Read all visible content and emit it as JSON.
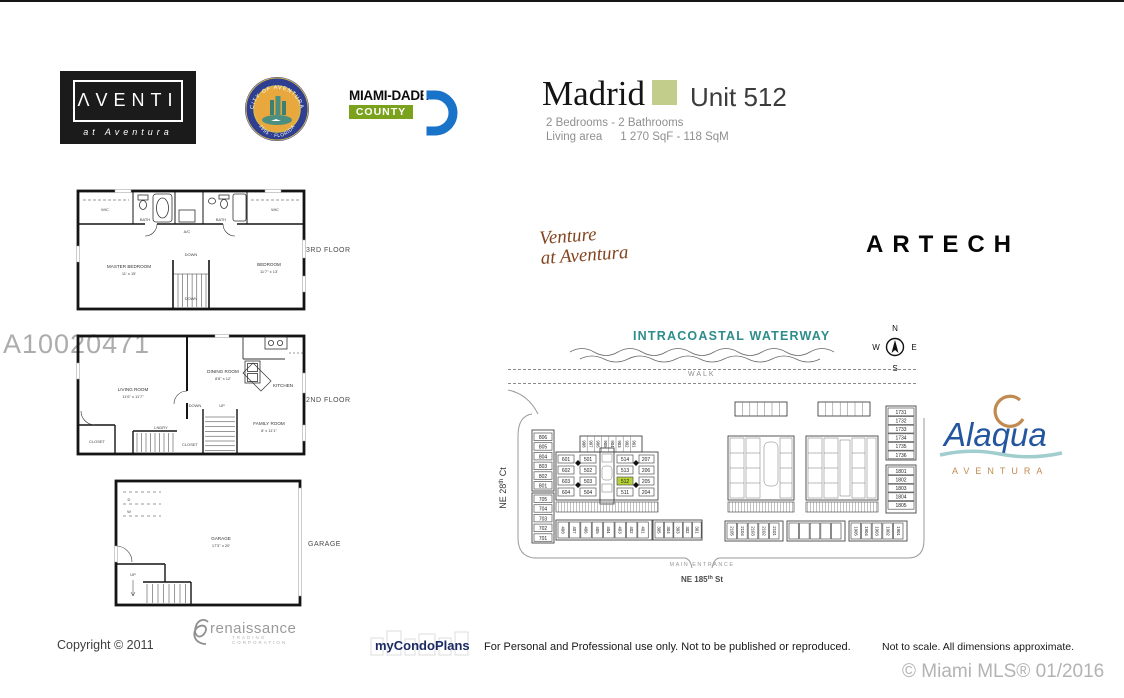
{
  "header": {
    "aventi": "ΛVENTI",
    "aventi_sub": "at Aventura",
    "seal_top": "CITY OF AVENTURA",
    "seal_bottom": "1995 · FLORIDA",
    "md_line1": "MIAMI-DADE",
    "md_line2": "COUNTY",
    "title": "Madrid",
    "unit": "Unit 512",
    "specs": "2 Bedrooms - 2 Bathrooms",
    "area_label": "Living area",
    "area_value": "1 270 SqF - 118 SqM",
    "accent_color": "#c2cd8c"
  },
  "watermark": "A10020471",
  "floorplans": {
    "third": {
      "label": "3RD FLOOR",
      "wic_left": "WIC",
      "wic_right": "WIC",
      "bath": "BATH",
      "bath2": "BATH",
      "ac": "A/C",
      "down": "DOWN",
      "down2": "DOWN",
      "master": "MASTER BEDROOM",
      "master_dim": "11' x 15'",
      "bedroom": "BEDROOM",
      "bedroom_dim": "11'7\" x 13'"
    },
    "second": {
      "label": "2ND FLOOR",
      "living": "LIVING ROOM",
      "living_dim": "11'6\" x 11'7\"",
      "dining": "DINING ROOM",
      "dining_dim": "8'8\" x 12'",
      "kitchen": "KITCHEN",
      "family": "FAMILY ROOM",
      "family_dim": "8' x 11'1\"",
      "down": "DOWN",
      "up": "UP",
      "laundry": "LNDRY",
      "closet": "CLOSET",
      "closet2": "CLOSET"
    },
    "garage": {
      "label": "GARAGE",
      "name": "GARAGE",
      "dim": "17'3\" x 20'",
      "up": "UP",
      "d": "D",
      "w": "W"
    }
  },
  "sitemap": {
    "venture_line1": "Venture",
    "venture_line2": "at Aventura",
    "artech": "ARTECH",
    "waterway": "INTRACOASTAL WATERWAY",
    "walk": "WALK",
    "main_entrance": "MAIN ENTRANCE",
    "street_left": [
      "NE 28",
      "th",
      " Ct"
    ],
    "street_bottom": [
      "NE 185",
      "th",
      " St"
    ],
    "compass": {
      "n": "N",
      "e": "E",
      "s": "S",
      "w": "W"
    },
    "highlighted_unit": "512",
    "highlight_color": "#b5d334",
    "left_units": [
      "806",
      "805",
      "804",
      "803",
      "802",
      "801",
      "705",
      "704",
      "703",
      "702",
      "701"
    ],
    "top_units": [
      "908",
      "907",
      "906",
      "905",
      "904",
      "903",
      "902",
      "901"
    ],
    "col_600": [
      "601",
      "602",
      "603",
      "604"
    ],
    "col_500": [
      "501",
      "502",
      "503",
      "504"
    ],
    "col_510": [
      "514",
      "513",
      "512",
      "511"
    ],
    "col_200": [
      "207",
      "206",
      "205",
      "204"
    ],
    "row_400": [
      "408",
      "407",
      "406",
      "405",
      "404",
      "403",
      "402",
      "401"
    ],
    "row_300": [
      "305",
      "304",
      "303",
      "302",
      "301"
    ],
    "right_units": [
      "1731",
      "1732",
      "1733",
      "1734",
      "1735",
      "1736",
      "1801",
      "1802",
      "1803",
      "1804",
      "1805"
    ],
    "row_2100": [
      "2105",
      "2104",
      "2103",
      "2102",
      "2101"
    ],
    "row_1900": [
      "1905",
      "1904",
      "1903",
      "1902",
      "1901"
    ]
  },
  "alaqua": {
    "name": "Alaqua",
    "sub": "AVENTURA"
  },
  "footer": {
    "copyright": "Copyright © 2011",
    "renaissance": "renaissance",
    "renaissance_sub": "TRADING CORPORATION",
    "mycondoplans": "myCondoPlans",
    "disclaimer": "For Personal and Professional use only.  Not to be published or reproduced.",
    "scale_note": "Not to scale.  All dimensions approximate.",
    "mls": "© Miami MLS® 01/2016"
  }
}
